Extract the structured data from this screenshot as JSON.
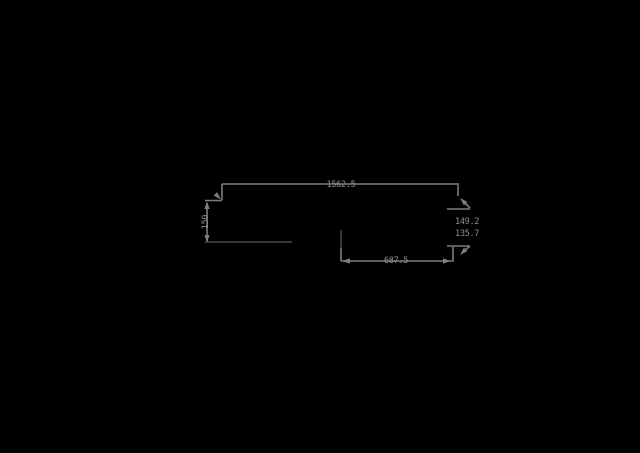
{
  "canvas": {
    "width": 640,
    "height": 453,
    "background_color": "#000000"
  },
  "drawing": {
    "type": "cad-dimension-drawing",
    "colors": {
      "dimension_line": "#7e7e7e",
      "object_line": "#6b6b6b",
      "text": "#8e8e8e"
    },
    "dimensions": {
      "top_width": {
        "label": "1562.5"
      },
      "left_height": {
        "label": "150"
      },
      "bottom_width": {
        "label": "687.5"
      },
      "right_upper": {
        "label": "149.2"
      },
      "right_lower": {
        "label": "135.7"
      }
    }
  }
}
